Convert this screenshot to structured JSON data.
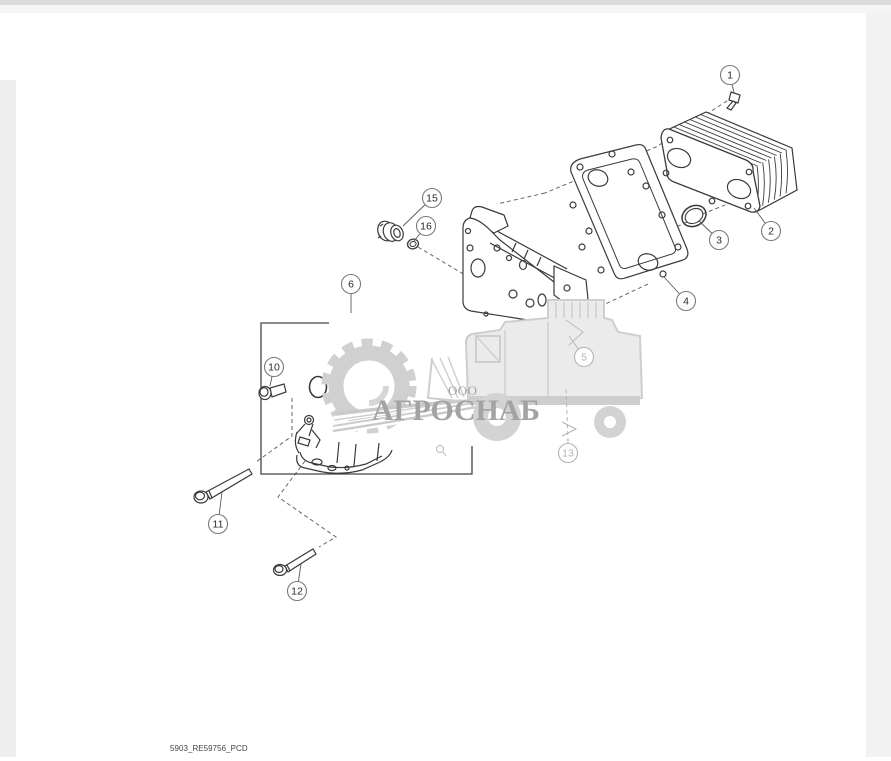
{
  "window": {
    "top_bar_color": "#dbdbdb",
    "upper_strip_color": "#f5f5f5",
    "left_margin_color": "#eeeeee",
    "right_margin_color": "#f2f2f2",
    "canvas_color": "#ffffff"
  },
  "watermark": {
    "company_prefix": "ООО",
    "company_name": "АГРОСНАБ",
    "logo_color": "#d0d0d0",
    "text_color": "#a3a3a3"
  },
  "diagram": {
    "footer_code": "5903_RE59756_PCD",
    "line_color": "#3a3a3a",
    "balloon_stroke": "#7a7a7a",
    "balloon_text_color": "#2b2b2b",
    "faded_color": "#b3b3b3",
    "callouts": [
      {
        "label": "1",
        "cx": 730,
        "cy": 75,
        "lx": 734,
        "ly": 93,
        "faded": false
      },
      {
        "label": "2",
        "cx": 771,
        "cy": 231,
        "lx": 754,
        "ly": 208,
        "faded": false
      },
      {
        "label": "3",
        "cx": 719,
        "cy": 240,
        "lx": 699,
        "ly": 221,
        "faded": false
      },
      {
        "label": "4",
        "cx": 686,
        "cy": 301,
        "lx": 664,
        "ly": 277,
        "faded": false
      },
      {
        "label": "5",
        "cx": 584,
        "cy": 357,
        "lx": 569,
        "ly": 336,
        "faded": true
      },
      {
        "label": "6",
        "cx": 351,
        "cy": 284,
        "lx": 351,
        "ly": 313,
        "faded": false
      },
      {
        "label": "10",
        "cx": 274,
        "cy": 367,
        "lx": 270,
        "ly": 386,
        "faded": false
      },
      {
        "label": "11",
        "cx": 218,
        "cy": 524,
        "lx": 222,
        "ly": 492,
        "faded": false
      },
      {
        "label": "12",
        "cx": 297,
        "cy": 591,
        "lx": 301,
        "ly": 564,
        "faded": false
      },
      {
        "label": "13",
        "cx": 568,
        "cy": 453,
        "lx": 568,
        "ly": 441,
        "faded": true
      },
      {
        "label": "15",
        "cx": 432,
        "cy": 198,
        "lx": 403,
        "ly": 226,
        "faded": false
      },
      {
        "label": "16",
        "cx": 426,
        "cy": 226,
        "lx": 414,
        "ly": 241,
        "faded": false
      }
    ]
  }
}
